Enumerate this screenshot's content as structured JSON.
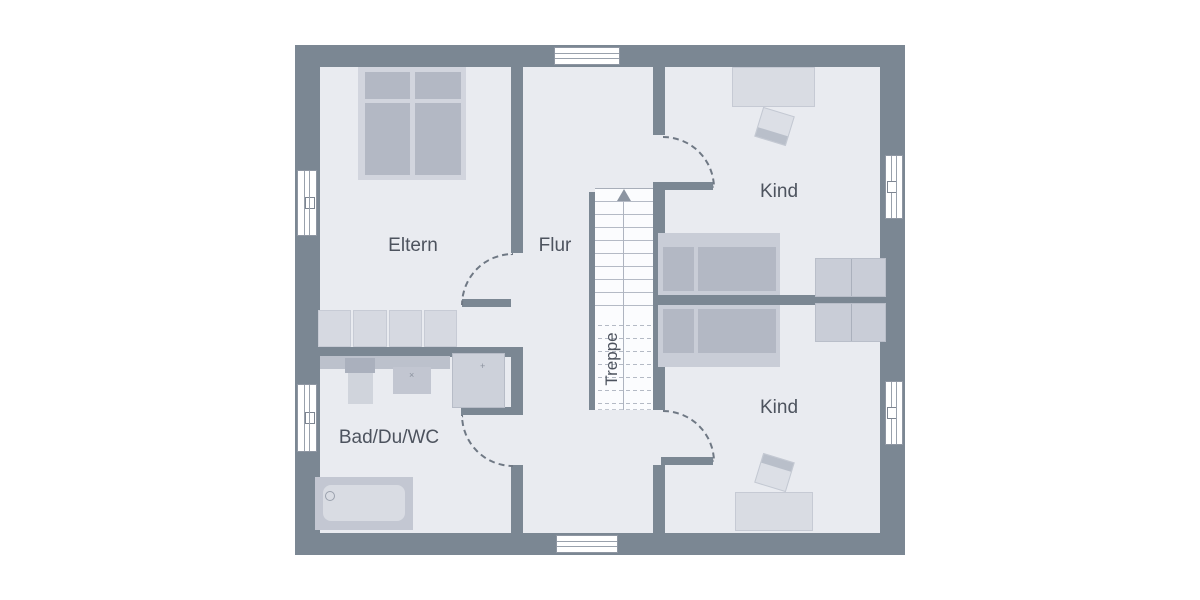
{
  "plan": {
    "type": "floor-plan",
    "colors": {
      "wall": "#7b8793",
      "floor": "#e9ebf0",
      "background": "#ffffff",
      "furniture_light": "#d8dbe2",
      "furniture_mid": "#bcc1cc",
      "text": "#4d535e"
    }
  },
  "rooms": {
    "eltern": {
      "label": "Eltern"
    },
    "flur": {
      "label": "Flur"
    },
    "kind_top": {
      "label": "Kind"
    },
    "kind_bottom": {
      "label": "Kind"
    },
    "bad": {
      "label": "Bad/Du/WC"
    }
  },
  "stairs": {
    "label": "Treppe",
    "direction": "up",
    "solid_steps": 9,
    "dashed_steps": 8
  },
  "fixtures": {
    "shower_faucet_icon": "+",
    "basin_faucet_icon": "×"
  }
}
